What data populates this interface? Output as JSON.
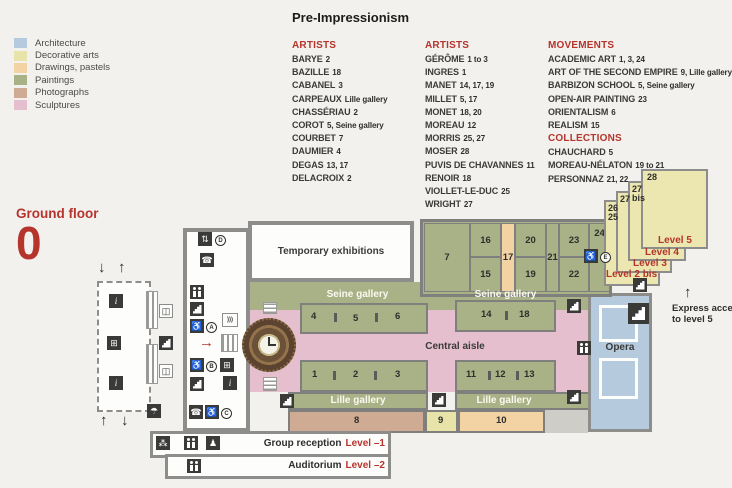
{
  "title": "Pre-Impressionism",
  "colors": {
    "accent_red": "#b5342c",
    "wall_gray": "#8d8d8b",
    "architecture": "#b5cbdd",
    "decorative_arts": "#e8e3a8",
    "drawings_pastels": "#f3d3a4",
    "paintings": "#a9b287",
    "photographs": "#cfab93",
    "sculptures": "#e5bfcd"
  },
  "legend": {
    "items": [
      {
        "label": "Architecture",
        "color": "#b5cbdd"
      },
      {
        "label": "Decorative arts",
        "color": "#e8e3a8"
      },
      {
        "label": "Drawings, pastels",
        "color": "#f3d3a4"
      },
      {
        "label": "Paintings",
        "color": "#a9b287"
      },
      {
        "label": "Photographs",
        "color": "#cfab93"
      },
      {
        "label": "Sculptures",
        "color": "#e5bfcd"
      }
    ]
  },
  "lists": {
    "artists1": {
      "heading": "ARTISTS",
      "entries": [
        {
          "name": "BARYE",
          "rooms": "2"
        },
        {
          "name": "BAZILLE",
          "rooms": "18"
        },
        {
          "name": "CABANEL",
          "rooms": "3"
        },
        {
          "name": "CARPEAUX",
          "rooms": "Lille gallery"
        },
        {
          "name": "CHASSÉRIAU",
          "rooms": "2"
        },
        {
          "name": "COROT",
          "rooms": "5, Seine gallery"
        },
        {
          "name": "COURBET",
          "rooms": "7"
        },
        {
          "name": "DAUMIER",
          "rooms": "4"
        },
        {
          "name": "DEGAS",
          "rooms": "13, 17"
        },
        {
          "name": "DELACROIX",
          "rooms": "2"
        }
      ]
    },
    "artists2": {
      "heading": "ARTISTS",
      "entries": [
        {
          "name": "GÉRÔME",
          "rooms": "1 to 3"
        },
        {
          "name": "INGRES",
          "rooms": "1"
        },
        {
          "name": "MANET",
          "rooms": "14, 17, 19"
        },
        {
          "name": "MILLET",
          "rooms": "5, 17"
        },
        {
          "name": "MONET",
          "rooms": "18, 20"
        },
        {
          "name": "MOREAU",
          "rooms": "12"
        },
        {
          "name": "MORRIS",
          "rooms": "25, 27"
        },
        {
          "name": "MOSER",
          "rooms": "28"
        },
        {
          "name": "PUVIS DE CHAVANNES",
          "rooms": "11"
        },
        {
          "name": "RENOIR",
          "rooms": "18"
        },
        {
          "name": "VIOLLET-LE-DUC",
          "rooms": "25"
        },
        {
          "name": "WRIGHT",
          "rooms": "27"
        }
      ]
    },
    "movements": {
      "heading": "MOVEMENTS",
      "entries": [
        {
          "name": "ACADEMIC ART",
          "rooms": "1, 3, 24"
        },
        {
          "name": "ART OF THE SECOND EMPIRE",
          "rooms": "9, Lille gallery"
        },
        {
          "name": "BARBIZON SCHOOL",
          "rooms": "5, Seine gallery"
        },
        {
          "name": "OPEN-AIR PAINTING",
          "rooms": "23"
        },
        {
          "name": "ORIENTALISM",
          "rooms": "6"
        },
        {
          "name": "REALISM",
          "rooms": "15"
        }
      ]
    },
    "collections": {
      "heading": "COLLECTIONS",
      "entries": [
        {
          "name": "CHAUCHARD",
          "rooms": "5"
        },
        {
          "name": "MOREAU-NÉLATON",
          "rooms": "19 to 21"
        },
        {
          "name": "PERSONNAZ",
          "rooms": "21, 22"
        }
      ]
    }
  },
  "floor": {
    "label": "Ground floor",
    "number": "0"
  },
  "plan": {
    "labels": {
      "temporary": "Temporary exhibitions",
      "seine": "Seine gallery",
      "central": "Central aisle",
      "lille": "Lille gallery",
      "opera": "Opera",
      "express_line1": "Express access",
      "express_line2": "to level 5"
    },
    "rooms": {
      "r1": "1",
      "r2": "2",
      "r3": "3",
      "r4": "4",
      "r5": "5",
      "r6": "6",
      "r7": "7",
      "r8": "8",
      "r9": "9",
      "r10": "10",
      "r11": "11",
      "r12": "12",
      "r13": "13",
      "r14": "14",
      "r15": "15",
      "r16": "16",
      "r17": "17",
      "r18": "18",
      "r19": "19",
      "r20": "20",
      "r21": "21",
      "r22": "22",
      "r23": "23",
      "r24": "24"
    },
    "levels": [
      {
        "number": "28",
        "label": "Level 5"
      },
      {
        "number": "27 bis",
        "label": "Level 4"
      },
      {
        "number": "27",
        "label": "Level 3"
      },
      {
        "number": "26",
        "number2": "25",
        "label": "Level 2 bis"
      }
    ],
    "letters": {
      "a": "A",
      "b": "B",
      "c": "C",
      "d": "D",
      "e": "E"
    }
  },
  "bottom": {
    "group": {
      "label": "Group reception",
      "level": "Level –1"
    },
    "auditorium": {
      "label": "Auditorium",
      "level": "Level –2"
    }
  },
  "icons": {
    "arrow_up": "↑",
    "arrow_down": "↓",
    "arrow_right": "→",
    "phone": "☎",
    "info": "i",
    "audio": ")))",
    "elevator": "⇅",
    "grid": "⊞",
    "book": "◫",
    "umbrella": "☂",
    "group": "⁂",
    "baby": "♟",
    "wheelchair": "♿"
  }
}
